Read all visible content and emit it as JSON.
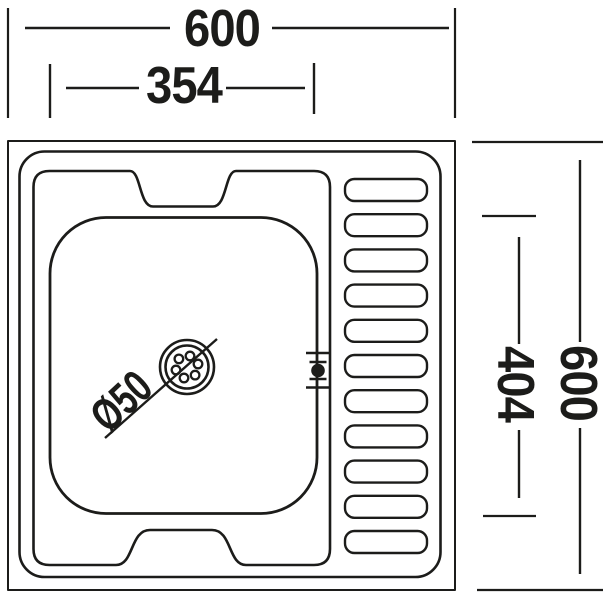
{
  "labels": {
    "overall_width": "600",
    "bowl_width": "354",
    "overall_height": "600",
    "bowl_height": "404",
    "drain_diameter": "Ø50"
  },
  "style": {
    "line_color": "#1c1c1a",
    "background_color": "#ffffff"
  },
  "drainboard": {
    "rib_count": 11
  }
}
